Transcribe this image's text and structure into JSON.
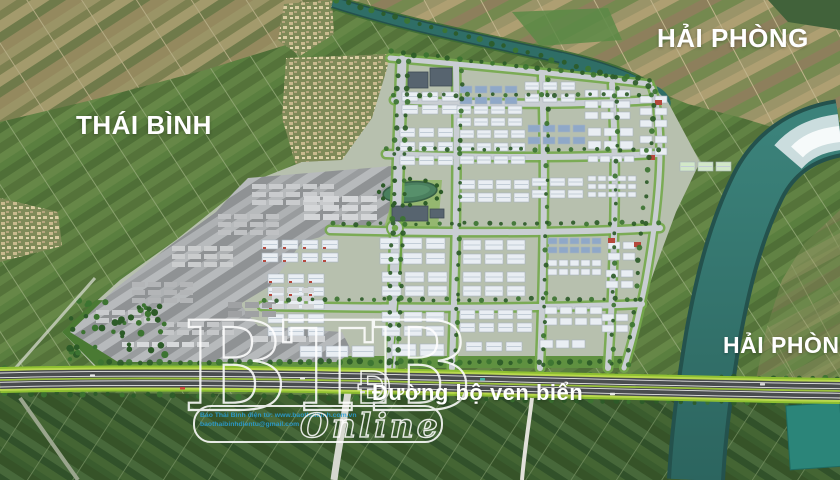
{
  "labels": {
    "region_top_left": "THÁI BÌNH",
    "region_top_right": "HẢI PHÒNG",
    "region_mid_right": "HẢI PHÒNG",
    "road": "Đường bộ ven biển",
    "road_drop_cap": "Đ"
  },
  "watermark": {
    "logo_text": "BTB",
    "script_text": "Online",
    "credit_line1": "Báo Thái Bình điện tử: www.baothaibinh.com.vn",
    "credit_line2": "baothaibinhdientu@gmail.com"
  },
  "colors": {
    "farm_green": "#5e7c41",
    "farm_olive": "#8c8a5c",
    "farm_dark": "#3e5a2f",
    "river_teal": "#2f6e66",
    "river_dark": "#24524d",
    "river_shine": "#dfe9ec",
    "park_ground": "#b7c0ae",
    "lawn": "#74a84b",
    "road_grey": "#c9ced3",
    "asphalt": "#494c4e",
    "highway_green": "#8fc032",
    "building_white": "#e9eef3",
    "building_blue": "#8fa8c8",
    "building_dark": "#57646f",
    "building_green": "#d2e8c8",
    "accent_red": "#b5483c",
    "tree_green": "#2d5b28",
    "grey_zone": "#a4a7a9",
    "label_white": "#ffffff",
    "credit_blue": "#2a9fd8"
  }
}
